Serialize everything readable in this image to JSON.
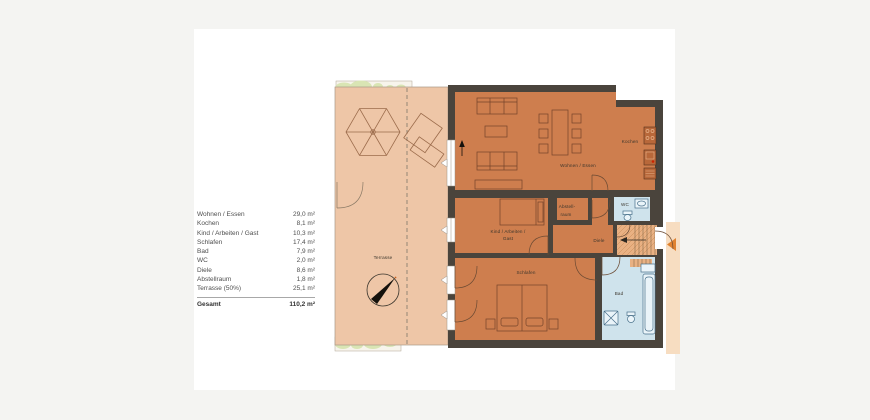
{
  "legend": {
    "rows": [
      {
        "name": "Wohnen / Essen",
        "area": "29,0 m²"
      },
      {
        "name": "Kochen",
        "area": "8,1 m²"
      },
      {
        "name": "Kind / Arbeiten / Gast",
        "area": "10,3 m²"
      },
      {
        "name": "Schlafen",
        "area": "17,4 m²"
      },
      {
        "name": "Bad",
        "area": "7,9 m²"
      },
      {
        "name": "WC",
        "area": "2,0 m²"
      },
      {
        "name": "Diele",
        "area": "8,6 m²"
      },
      {
        "name": "Abstellraum",
        "area": "1,8 m²"
      },
      {
        "name": "Terrasse (50%)",
        "area": "25,1 m²"
      }
    ],
    "total": {
      "name": "Gesamt",
      "area": "110,2 m²"
    }
  },
  "plan": {
    "labels": {
      "terrasse": "Terrasse",
      "wohnen_essen": "Wohnen / Essen",
      "kochen": "Kochen",
      "kind_line1": "Kind / Arbeiten /",
      "kind_line2": "Gast",
      "abstell_line1": "Abstell-",
      "abstell_line2": "raum",
      "diele": "Diele",
      "wc": "WC",
      "schlafen": "Schlafen",
      "bad": "Bad"
    },
    "colors": {
      "wall": "#4a443c",
      "room": "#ce7e4e",
      "terrace": "#eec6a7",
      "wet_room": "#cfe3ec",
      "stairs": "#e9b183",
      "plants": "#d9e5b4",
      "entry_strip": "#f7ddc1",
      "entry_arrow": "#e0822f"
    }
  }
}
